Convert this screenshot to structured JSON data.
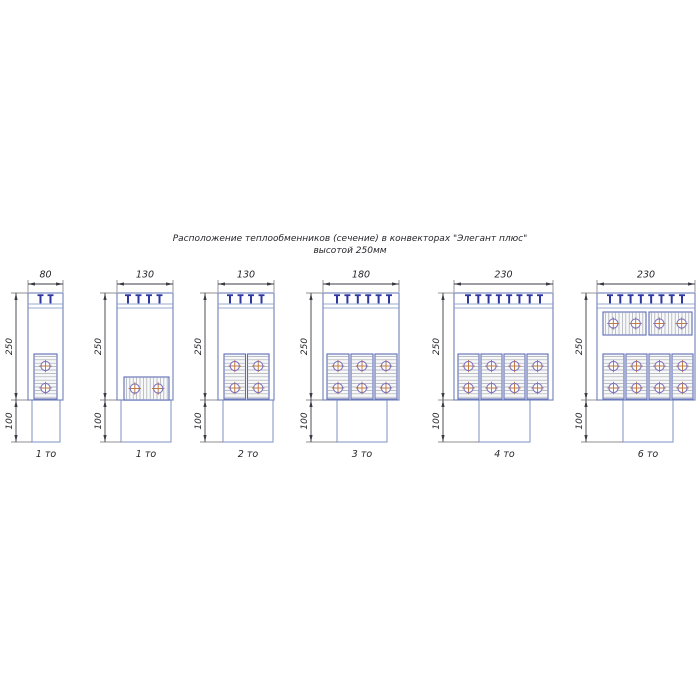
{
  "title": {
    "line1": "Расположение теплообменников (сечение) в конвекторах \"Элегант плюс\"",
    "line2": "высотой 250мм"
  },
  "dimensions": {
    "body_height": "250",
    "leg_height": "100"
  },
  "colors": {
    "body_stroke": "#7b8abf",
    "band_stroke": "#9aa8d0",
    "leg_stroke": "#8a9cc8",
    "clip": "#2e379f",
    "cell_stroke": "#5f6cb5",
    "cell_fill": "#f7f8f9",
    "hatch": "#a6a9b0",
    "circle_ring": "#8073bd",
    "circle_cross": "#c07b43",
    "dim_line": "#3c3c44",
    "ext_line": "#6a6a72",
    "text": "#26262c"
  },
  "geometry": {
    "body_top": 293,
    "band_line1": 304,
    "band_line2": 308,
    "body_bottom": 400,
    "leg_bottom": 442,
    "width_dim_y": 284,
    "width_label_y": 277.5,
    "name_label_y": 457,
    "column_circle_rows": [
      366,
      388
    ],
    "circle_radius": 4.6
  },
  "convectors": [
    {
      "width_label": "80",
      "name": "1 то",
      "body_x": 28,
      "body_w": 35,
      "leg_x": 32,
      "leg_w": 28,
      "vdim_x": 16,
      "clips": {
        "count": 2,
        "x0": 40.5,
        "x1": 50.5
      },
      "exchangers": [
        {
          "kind": "columns",
          "x": 34,
          "w": 23,
          "cells": 1,
          "y": 354,
          "h": 45
        }
      ]
    },
    {
      "width_label": "130",
      "name": "1 то",
      "body_x": 117,
      "body_w": 56,
      "leg_x": 121,
      "leg_w": 50,
      "vdim_x": 105,
      "clips": {
        "count": 4,
        "x0": 128,
        "x1": 159.5
      },
      "exchangers": [
        {
          "kind": "wide",
          "x": 124,
          "w": 45,
          "cells": 1,
          "y": 377,
          "h": 23,
          "circle_y": 388.5
        }
      ]
    },
    {
      "width_label": "130",
      "name": "2 то",
      "body_x": 218,
      "body_w": 56,
      "leg_x": 223,
      "leg_w": 50,
      "vdim_x": 205,
      "clips": {
        "count": 4,
        "x0": 230,
        "x1": 261.5
      },
      "exchangers": [
        {
          "kind": "columns",
          "x": 224,
          "w": 45,
          "cells": 2,
          "y": 354,
          "h": 45
        }
      ]
    },
    {
      "width_label": "180",
      "name": "3 то",
      "body_x": 323,
      "body_w": 76,
      "leg_x": 337,
      "leg_w": 50,
      "vdim_x": 311,
      "clips": {
        "count": 6,
        "x0": 337,
        "x1": 389
      },
      "exchangers": [
        {
          "kind": "columns",
          "x": 327,
          "w": 70,
          "cells": 3,
          "y": 354,
          "h": 45
        }
      ]
    },
    {
      "width_label": "230",
      "name": "4 то",
      "body_x": 454,
      "body_w": 99,
      "leg_x": 479,
      "leg_w": 51,
      "vdim_x": 443,
      "clips": {
        "count": 8,
        "x0": 468,
        "x1": 540
      },
      "exchangers": [
        {
          "kind": "columns",
          "x": 458,
          "w": 90,
          "cells": 4,
          "y": 354,
          "h": 45
        }
      ]
    },
    {
      "width_label": "230",
      "name": "6 то",
      "body_x": 597,
      "body_w": 98,
      "leg_x": 623,
      "leg_w": 50,
      "vdim_x": 586,
      "clips": {
        "count": 8,
        "x0": 610,
        "x1": 682
      },
      "exchangers": [
        {
          "kind": "wide",
          "x": 603,
          "w": 89,
          "cells": 2,
          "y": 312,
          "h": 23,
          "circle_y": 323.5
        },
        {
          "kind": "columns",
          "x": 603,
          "w": 90,
          "cells": 4,
          "y": 354,
          "h": 45
        }
      ]
    }
  ]
}
